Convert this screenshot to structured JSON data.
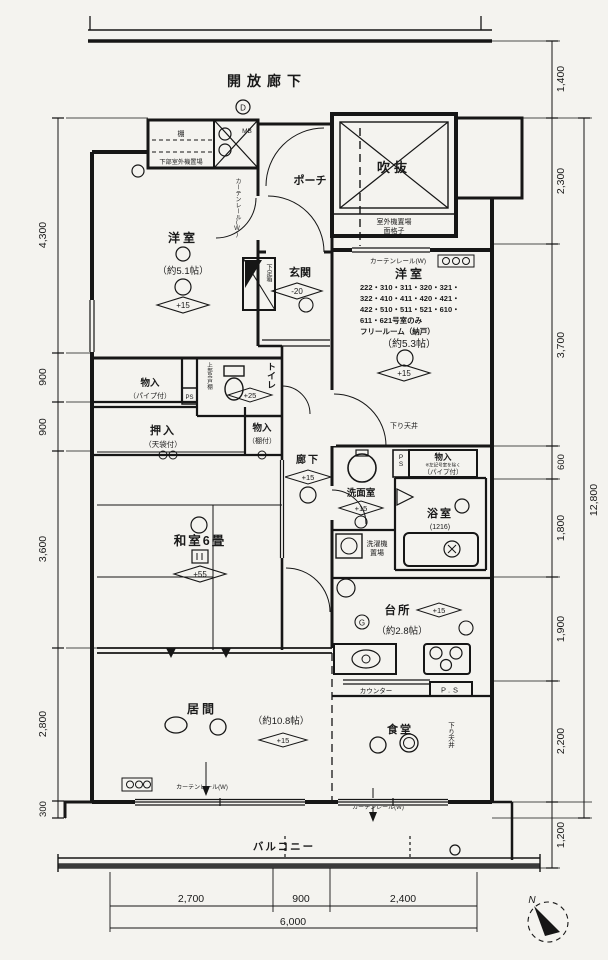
{
  "header": {
    "open_corridor": "開放廊下"
  },
  "rooms": {
    "shelf": "棚",
    "lower_outdoor": "下部室外機置場",
    "mb": "MB",
    "porch": "ポーチ",
    "void": "吹抜",
    "outdoor_unit": "室外機置場",
    "lattice": "面格子",
    "west1": {
      "name": "洋室",
      "size": "（約5.1帖）",
      "level": "+15"
    },
    "entrance": {
      "name": "玄関",
      "level": "-20",
      "shoebox": "下足箱"
    },
    "west2": {
      "name": "洋室",
      "rooms1": "222・310・311・320・321・",
      "rooms2": "322・410・411・420・421・",
      "rooms3": "422・510・511・521・610・",
      "rooms4": "611・621号室のみ",
      "rooms5": "フリールーム（納戸）",
      "size": "（約5.3帖）",
      "level": "+15"
    },
    "storage1": {
      "name": "物入",
      "sub": "（パイプ付）"
    },
    "toilet": {
      "name": "トイレ",
      "level": "+25",
      "shelf": "上部吊戸棚"
    },
    "closet": {
      "name": "押入",
      "sub": "（天袋付）"
    },
    "storage2": {
      "name": "物入",
      "sub": "（棚付）"
    },
    "hall": {
      "name": "廊下",
      "level": "+15"
    },
    "japanese": {
      "name": "和室6畳",
      "level": "+55"
    },
    "washroom": {
      "name": "洗面室",
      "level": "+15"
    },
    "laundry1": "洗濯機",
    "laundry2": "置場",
    "bath": {
      "name": "浴室",
      "size": "(1216)"
    },
    "storage3": {
      "name": "物入",
      "note": "※左記号室を除く",
      "sub": "（パイプ付）"
    },
    "kitchen": {
      "name": "台所",
      "size": "（約2.8帖）",
      "level": "+15"
    },
    "counter": "カウンター",
    "dining": "食堂",
    "living": {
      "name": "居間",
      "size": "（約10.8帖）",
      "level": "+15"
    },
    "balcony": "バルコニー",
    "lowered_ceiling": "下り天井",
    "curtain_rail": "カーテンレール(W)",
    "ps": "PS",
    "ps_dot": "P.S"
  },
  "marks": {
    "d": "D",
    "g": "G",
    "north": "N"
  },
  "dimensions": {
    "left": [
      "4,300",
      "900",
      "900",
      "3,600",
      "2,800",
      "300"
    ],
    "right": [
      "1,400",
      "2,300",
      "3,700",
      "600",
      "1,800",
      "1,900",
      "2,200",
      "1,200"
    ],
    "right_total": "12,800",
    "bottom": [
      "2,700",
      "900",
      "2,400"
    ],
    "bottom_total": "6,000"
  }
}
